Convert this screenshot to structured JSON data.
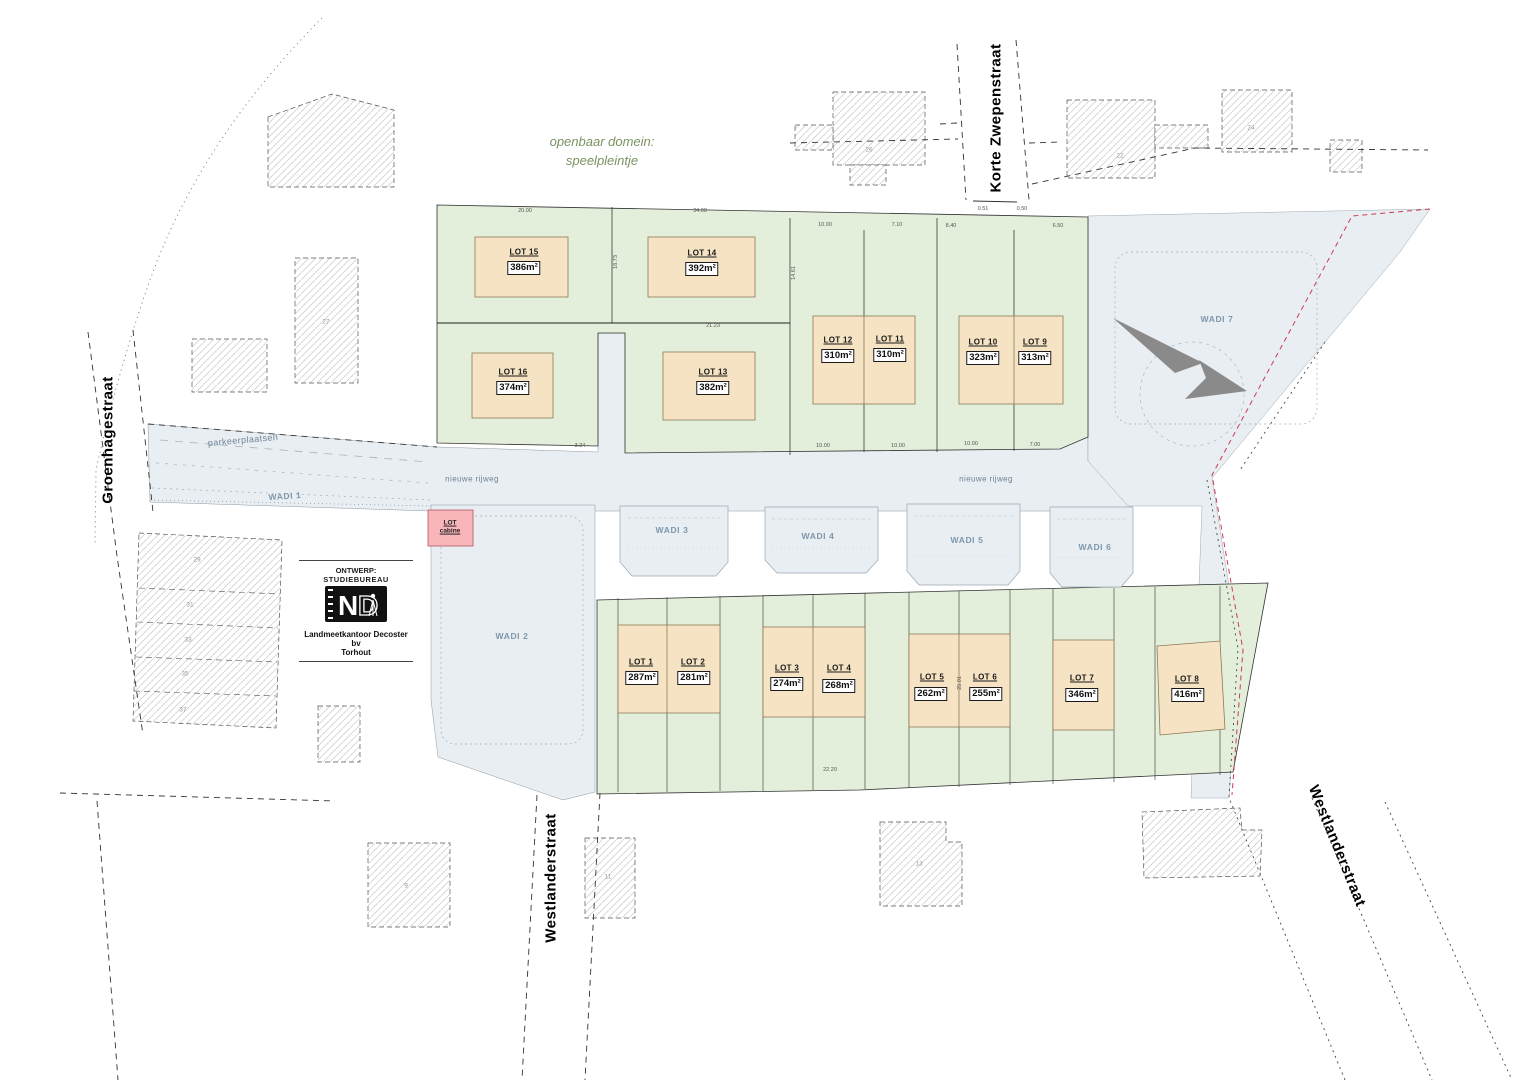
{
  "public_domain": {
    "line1": "openbaar domein:",
    "line2": "speelpleintje"
  },
  "streets": {
    "groenhagestraat": "Groenhagestraat",
    "korte_zwepenstraat": "Korte Zwepenstraat",
    "westlanderstraat_bottom": "Westlanderstraat",
    "westlanderstraat_right": "Westlanderstraat"
  },
  "roads": {
    "nieuwe_rijweg_left": "nieuwe rijweg",
    "nieuwe_rijweg_right": "nieuwe rijweg",
    "parkeerplaatsen": "parkeerplaatsen"
  },
  "wadis": {
    "w1": "WADI 1",
    "w2": "WADI 2",
    "w3": "WADI 3",
    "w4": "WADI 4",
    "w5": "WADI 5",
    "w6": "WADI 6",
    "w7": "WADI 7"
  },
  "cabine": {
    "line1": "LOT",
    "line2": "cabine"
  },
  "lots": [
    {
      "name": "LOT 1",
      "area": "287m²"
    },
    {
      "name": "LOT 2",
      "area": "281m²"
    },
    {
      "name": "LOT 3",
      "area": "274m²"
    },
    {
      "name": "LOT 4",
      "area": "268m²"
    },
    {
      "name": "LOT 5",
      "area": "262m²"
    },
    {
      "name": "LOT 6",
      "area": "255m²"
    },
    {
      "name": "LOT 7",
      "area": "346m²"
    },
    {
      "name": "LOT 8",
      "area": "416m²"
    },
    {
      "name": "LOT 9",
      "area": "313m²"
    },
    {
      "name": "LOT 10",
      "area": "323m²"
    },
    {
      "name": "LOT 11",
      "area": "310m²"
    },
    {
      "name": "LOT 12",
      "area": "310m²"
    },
    {
      "name": "LOT 13",
      "area": "382m²"
    },
    {
      "name": "LOT 14",
      "area": "392m²"
    },
    {
      "name": "LOT 15",
      "area": "386m²"
    },
    {
      "name": "LOT 16",
      "area": "374m²"
    }
  ],
  "logo": {
    "header1": "ONTWERP:",
    "header2": "STUDIEBUREAU",
    "mark": "ND",
    "company": "Landmeetkantoor Decoster bv",
    "city": "Torhout"
  },
  "house_numbers": [
    "26",
    "22",
    "24",
    "27",
    "29",
    "31",
    "33",
    "35",
    "37",
    "9",
    "11",
    "13"
  ],
  "dimensions": [
    "20.00",
    "34.00",
    "10.00",
    "7.10",
    "8.40",
    "6.50",
    "0.51",
    "0.50",
    "10.00",
    "10.00",
    "10.00",
    "7.00",
    "3.24",
    "18.73",
    "14.61",
    "25.01",
    "21.23",
    "22.20"
  ],
  "colors": {
    "lot_fill": "#f5e3c3",
    "green_fill": "#e3efdb",
    "water_fill": "#e9eef3",
    "cabine_fill": "#f9b6ba",
    "wadi_text": "#7d97ab",
    "green_text": "#7a9262",
    "red_boundary": "#cf3a50",
    "north_arrow": "#8a8a8a"
  }
}
